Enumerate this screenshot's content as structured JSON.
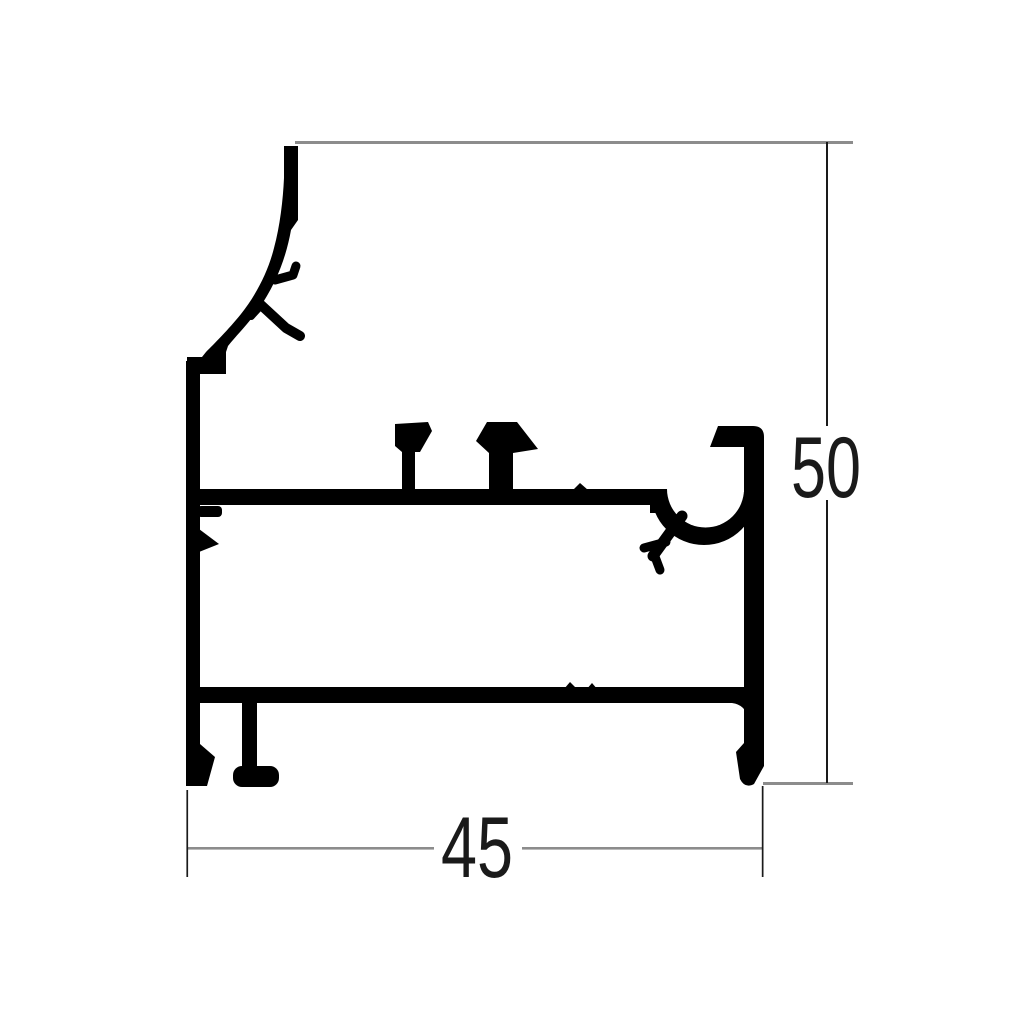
{
  "drawing": {
    "type": "technical-drawing",
    "subject": "aluminium extrusion profile cross-section",
    "dim_width_label": "45",
    "dim_height_label": "50",
    "colors": {
      "profile": "#000000",
      "dimension_line": "#8c8c8c",
      "extension_line": "#1a1a1a",
      "text": "#1a1a1a",
      "background": "#ffffff"
    }
  }
}
